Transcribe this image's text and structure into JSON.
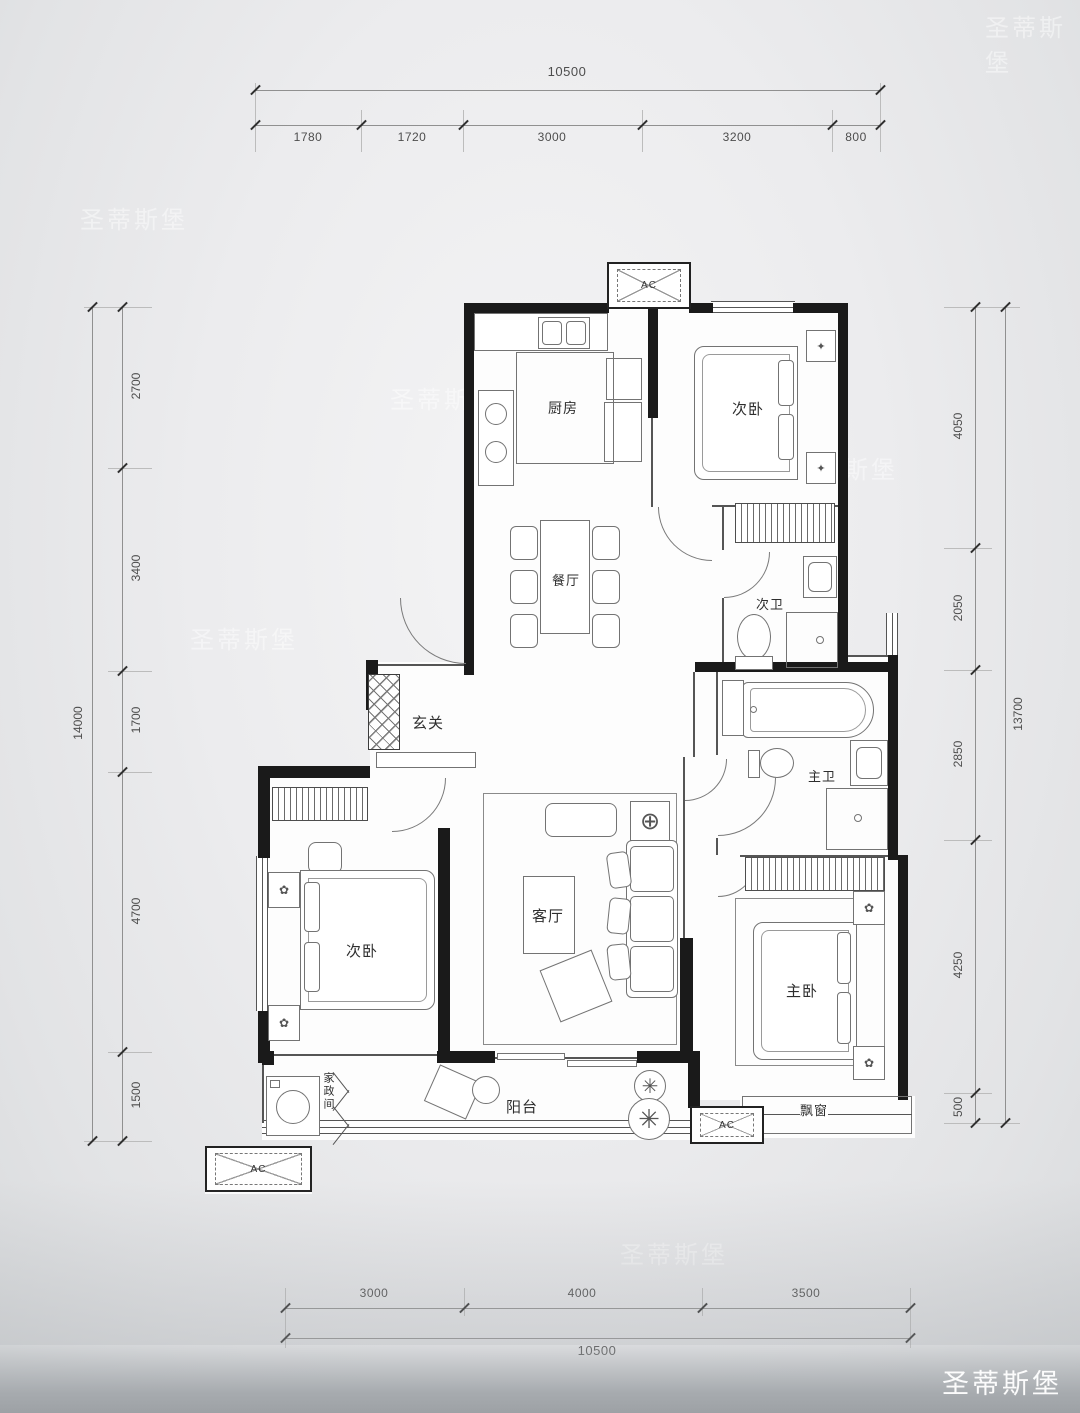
{
  "watermark": {
    "text": "圣蒂斯堡"
  },
  "dimensions": {
    "top": {
      "total": "10500",
      "segments": [
        "1780",
        "1720",
        "3000",
        "3200",
        "800"
      ]
    },
    "bottom": {
      "total": "10500",
      "segments": [
        "3000",
        "4000",
        "3500"
      ]
    },
    "left": {
      "total": "14000",
      "segments": [
        "2700",
        "3400",
        "1700",
        "4700",
        "1500"
      ]
    },
    "right": {
      "total": "13700",
      "segments": [
        "4050",
        "2050",
        "2850",
        "4250",
        "500"
      ]
    }
  },
  "rooms": {
    "kitchen": "厨房",
    "bedroom_top": "次卧",
    "dining": "餐厅",
    "bath_second": "次卫",
    "foyer": "玄关",
    "bedroom_left": "次卧",
    "living": "客厅",
    "bath_master": "主卫",
    "bedroom_master": "主卧",
    "balcony": "阳台",
    "bay_window": "飘窗",
    "laundry": "家政间"
  },
  "labels": {
    "ac": "AC"
  }
}
